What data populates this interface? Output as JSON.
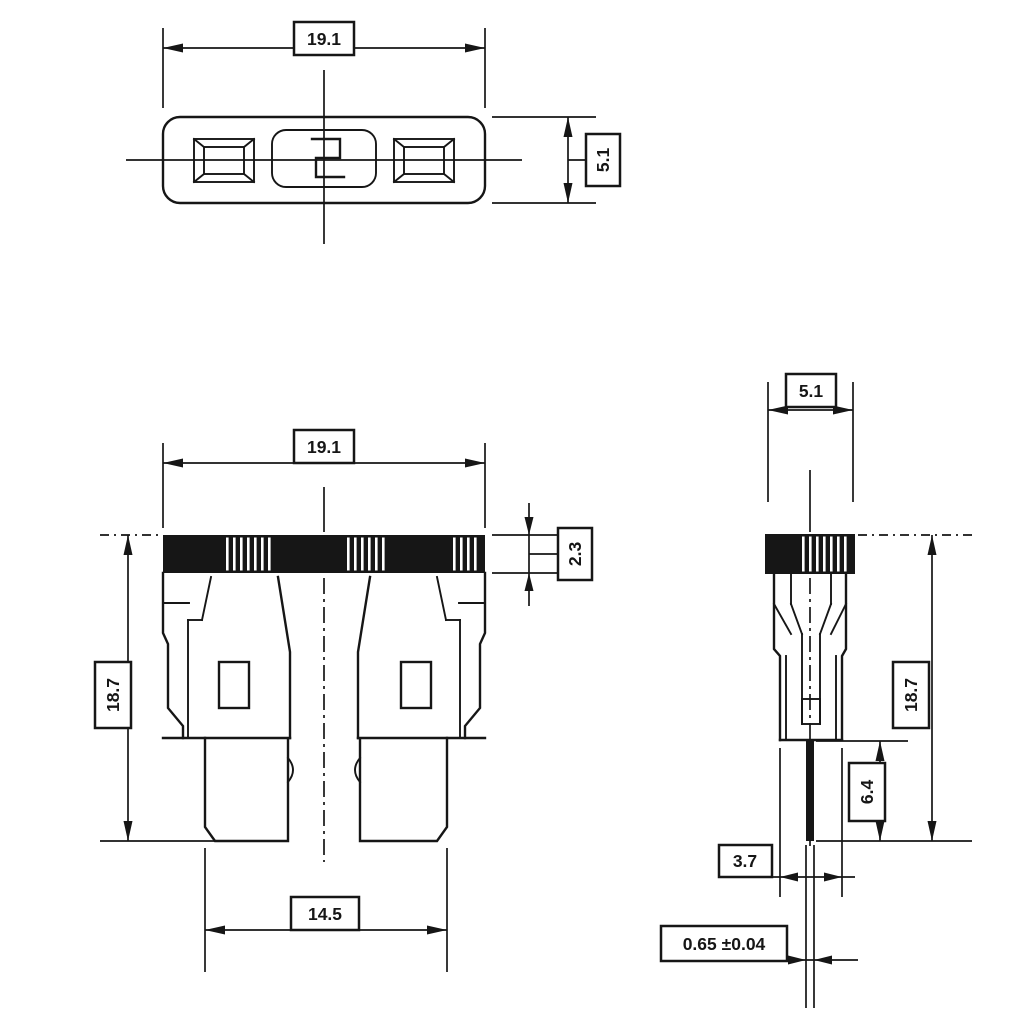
{
  "colors": {
    "ink": "#161616",
    "paper": "#ffffff"
  },
  "dimensions": {
    "top_view": {
      "width": "19.1",
      "depth": "5.1"
    },
    "front_view": {
      "width": "19.1",
      "height": "18.7",
      "cap_height": "2.3",
      "terminal_span": "14.5"
    },
    "side_view": {
      "depth": "5.1",
      "height": "18.7",
      "blade_length": "6.4",
      "lower_body_depth": "3.7",
      "blade_thickness": "0.65 ±0.04"
    }
  }
}
